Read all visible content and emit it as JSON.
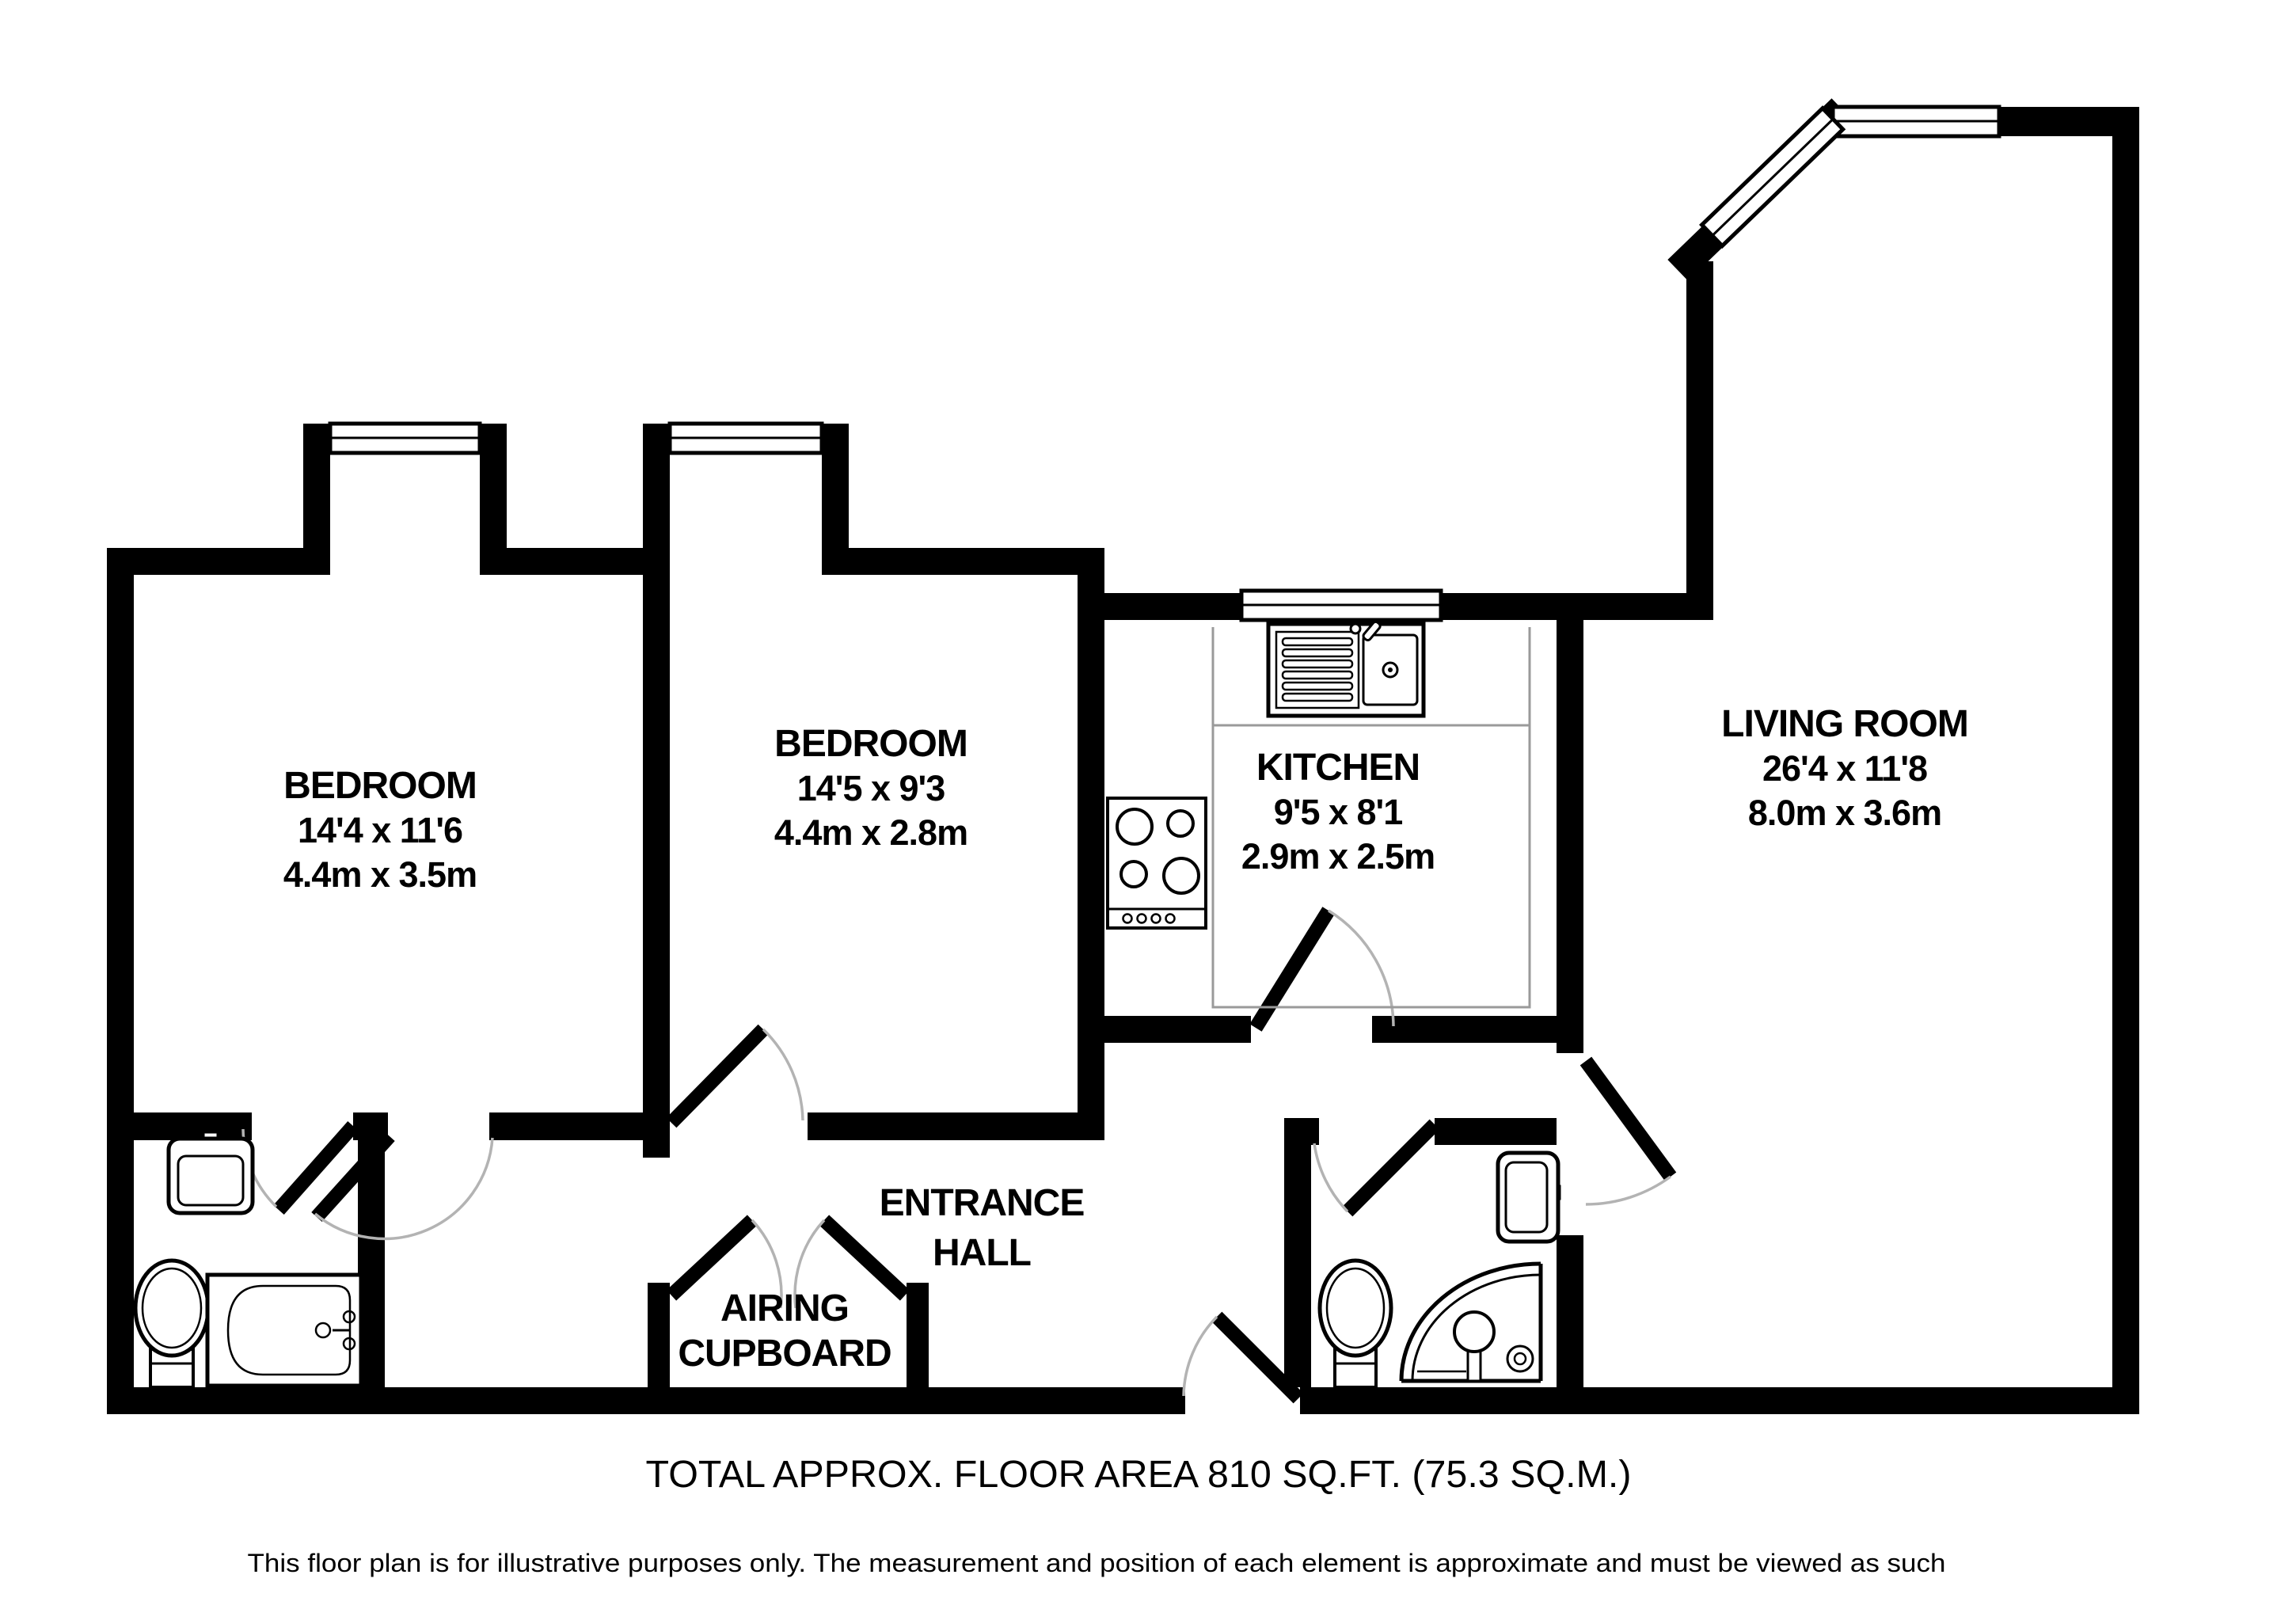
{
  "plan": {
    "rooms": {
      "bedroom1": {
        "name": "BEDROOM",
        "size_imperial": "14'4 x 11'6",
        "size_metric": "4.4m x 3.5m"
      },
      "bedroom2": {
        "name": "BEDROOM",
        "size_imperial": "14'5 x 9'3",
        "size_metric": "4.4m x 2.8m"
      },
      "kitchen": {
        "name": "KITCHEN",
        "size_imperial": "9'5 x 8'1",
        "size_metric": "2.9m x 2.5m"
      },
      "living_room": {
        "name": "LIVING ROOM",
        "size_imperial": "26'4 x 11'8",
        "size_metric": "8.0m x 3.6m"
      },
      "entrance_hall": {
        "name_line1": "ENTRANCE",
        "name_line2": "HALL"
      },
      "airing_cupboard": {
        "name_line1": "AIRING",
        "name_line2": "CUPBOARD"
      }
    },
    "footer": {
      "total_area": "TOTAL APPROX. FLOOR AREA 810 SQ.FT. (75.3 SQ.M.)",
      "disclaimer": "This floor plan is for illustrative purposes only.  The measurement and position of each element is approximate and must be viewed as such"
    },
    "colors": {
      "wall": "#000000",
      "background": "#ffffff",
      "door_arc": "#b3b3b3",
      "counter": "#9a9a9a"
    }
  }
}
